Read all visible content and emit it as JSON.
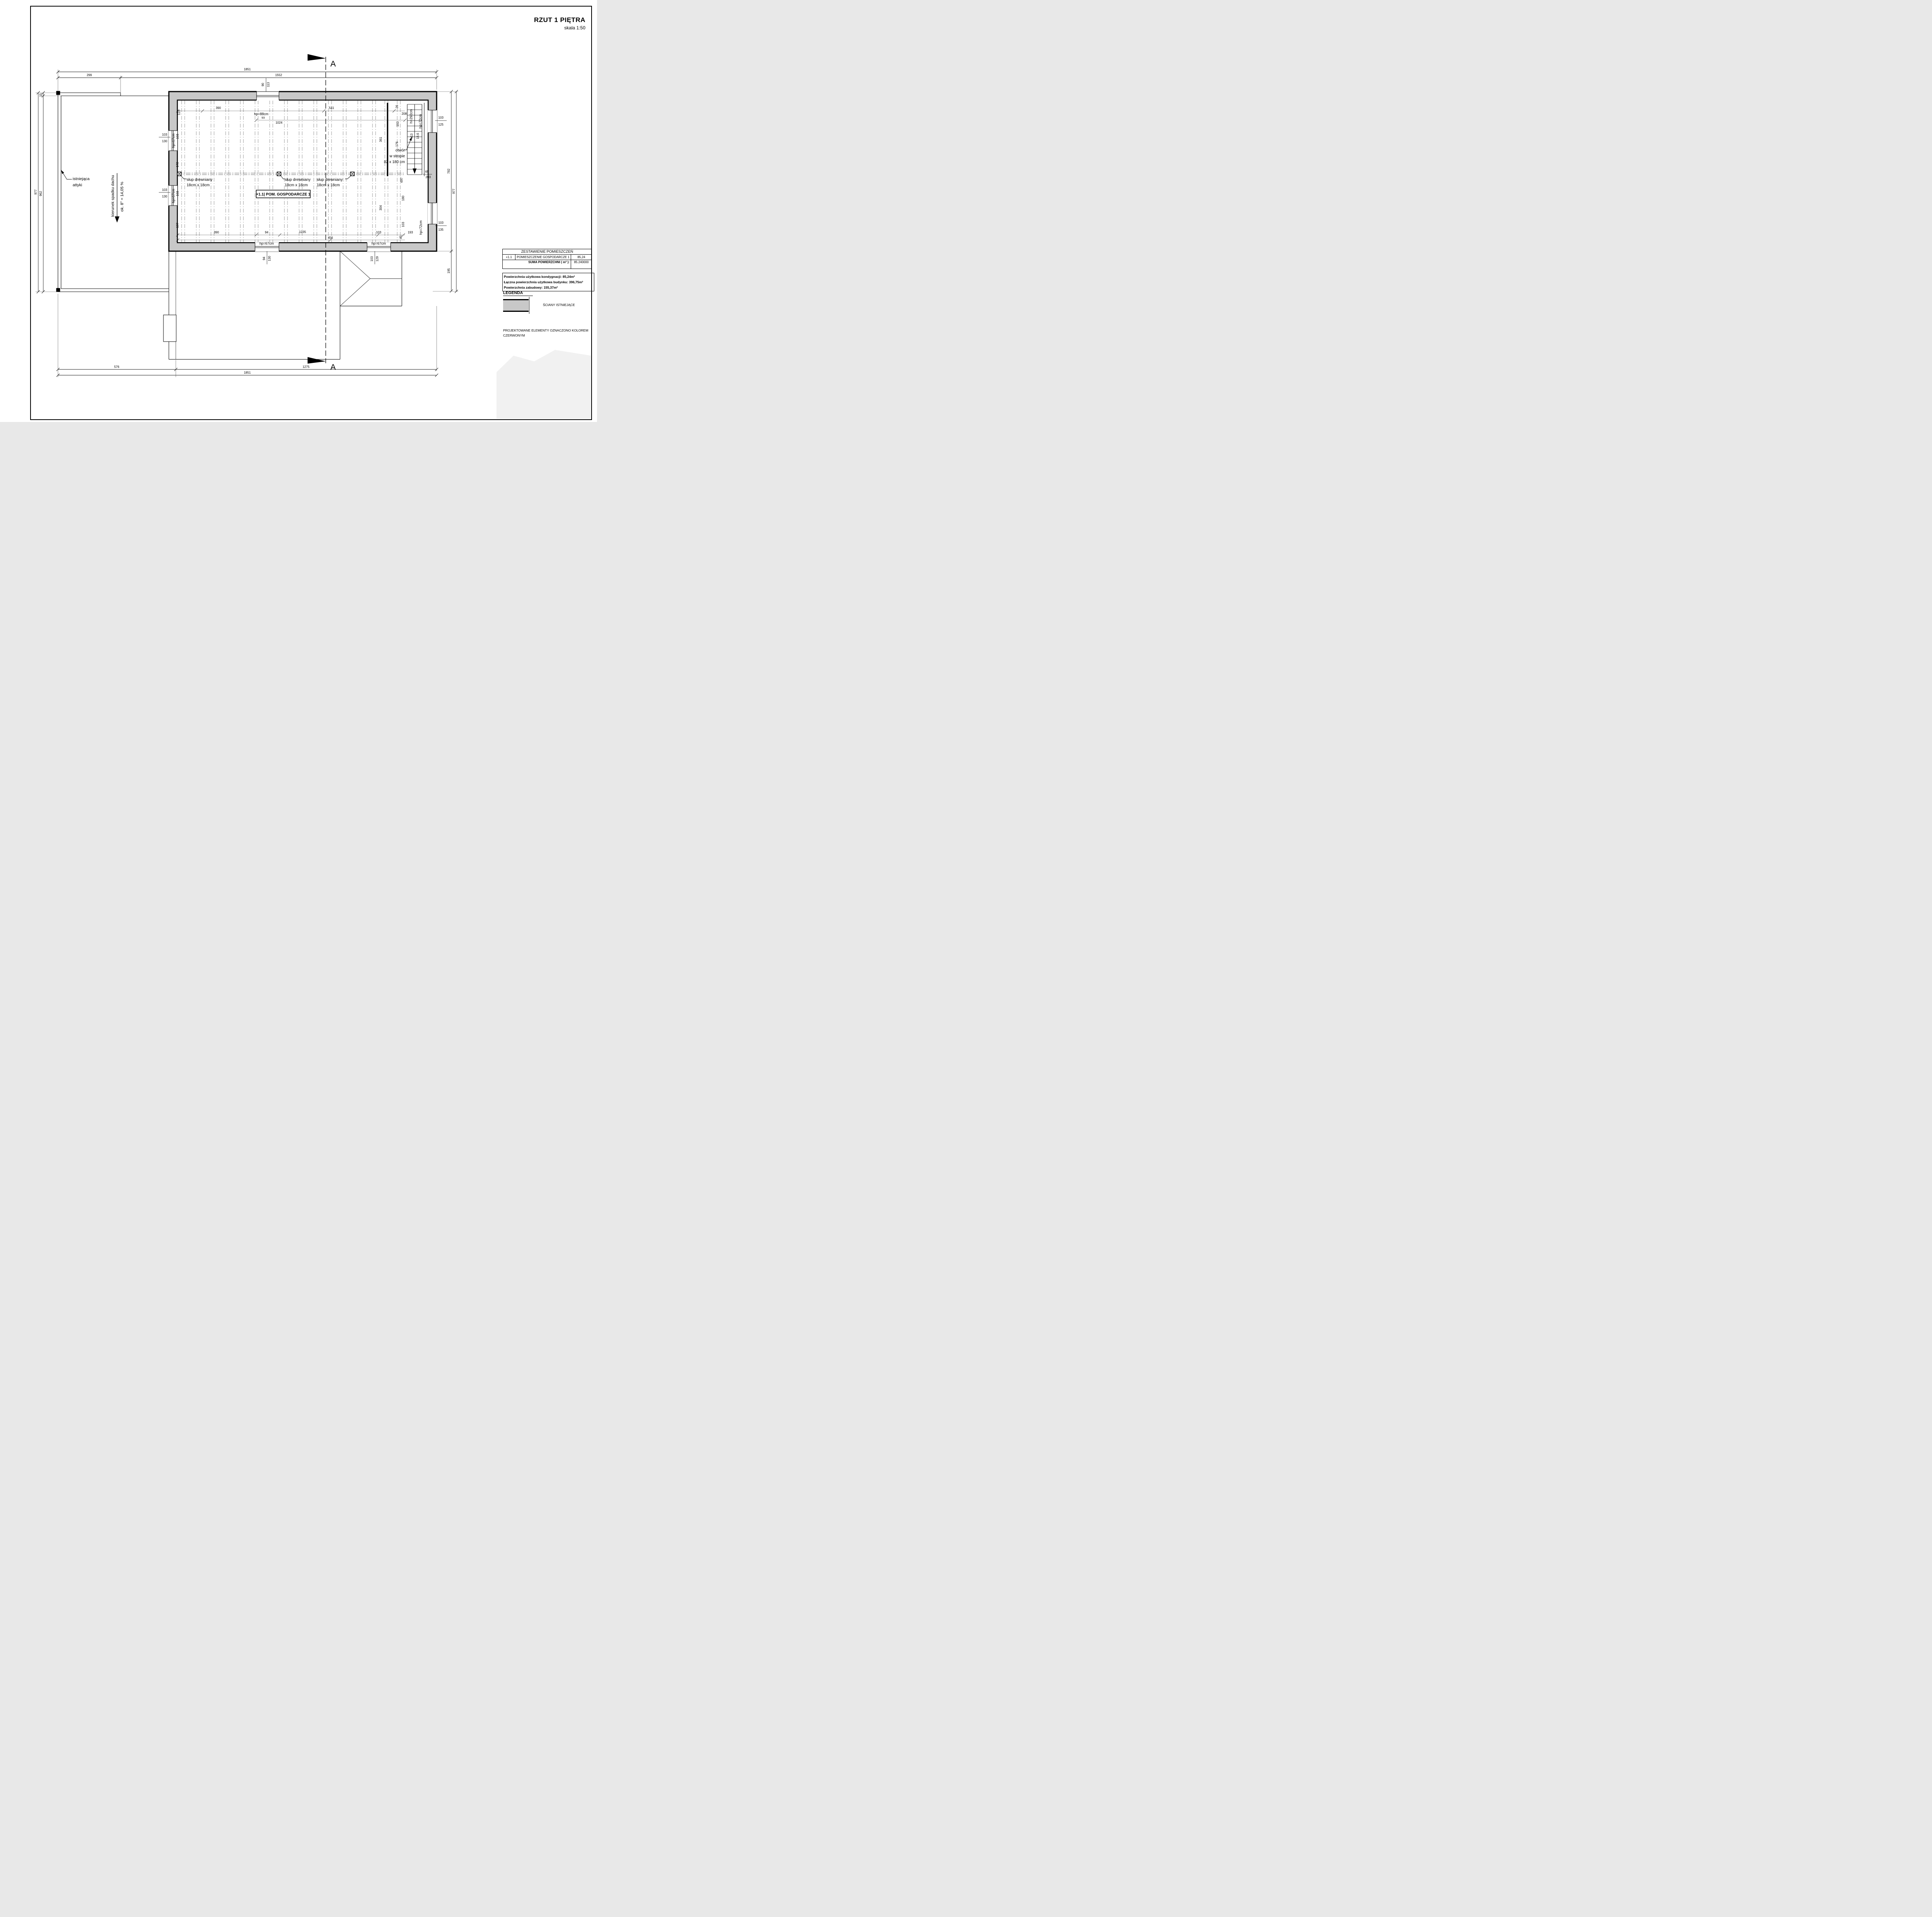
{
  "title": {
    "main": "RZUT 1 PIĘTRA",
    "scale": "skala 1:50"
  },
  "plan": {
    "room_label": "+1.1| POM. GOSPODARCZE 1",
    "attic_l1": "istniejąca",
    "attic_l2": "attyki",
    "roof_dir": "kierunek spadku dachu",
    "roof_slope": "ok. 8° = 14,05 %",
    "post_l1": "słup drewniany",
    "post_l2": "18cm x 18cm",
    "open_l1": "otwór",
    "open_l2": "w stropie",
    "open_l3": "82 x 180 cm",
    "stairs_count": "x13",
    "stairs_going": "18,6",
    "stairs_h": "h=292cm",
    "section": "A",
    "dims": {
      "t1851": "1851",
      "t299": "299",
      "t1552": "1552",
      "b576": "576",
      "b1275": "1275",
      "b1851": "1851",
      "l977": "977",
      "l15": "15",
      "l962": "962",
      "r782": "782",
      "r195": "195",
      "r977": "977",
      "tw_w": "90",
      "tw_h": "113",
      "tw_hp": "hp=88cm",
      "i122": "122",
      "i390": "390",
      "i93": "93",
      "i1024": "1024",
      "i541": "541",
      "i26": "26",
      "i208": "208",
      "i103s": "103",
      "i176": "176",
      "rw1_hp": "hp=72cm",
      "rw1_w": "103",
      "rw1_h": "125",
      "i361": "361",
      "i697": "697",
      "i180": "180",
      "i304": "304",
      "i103r": "103",
      "i65": "65",
      "i203": "203",
      "lw_hp": "hp=67cm",
      "lw_w": "103",
      "lw_h": "130",
      "il103a": "103",
      "il172": "172",
      "il103b": "103",
      "il197": "197",
      "bb390": "390",
      "bb94": "94",
      "bb1235": "1235",
      "bb456": "456",
      "bb103": "103",
      "bb45": "45",
      "bb193": "193",
      "bw_hp": "hp=67cm",
      "bw1_w": "94",
      "bw1_h": "130",
      "bw2_w": "103",
      "bw2_h": "129",
      "rw2_hp": "hp=72cm",
      "rw2_w": "103",
      "rw2_h": "135"
    }
  },
  "table": {
    "title": "ZESTAWIENIE POMIESZCZEŃ",
    "row_id": "+1.1",
    "row_name": "POMIESZCZENIE GOSPODARCZE 1",
    "row_area": "85,24",
    "sum_label": "SUMA POWIERZCHNI ( m² ):",
    "sum_value": "85.240000"
  },
  "summary": {
    "l1": "Powierzchnia użytkowa kondygnacji:  85,24m²",
    "l2": "Łączna powierzchnia użytkowa budynku:  396,75m²",
    "l3": "Powierzchnia zabudowy:  155,37m²"
  },
  "legend": {
    "title": "LEGENDA",
    "wall_label": "ŚCIANY ISTNIEJĄCE"
  },
  "note": {
    "l1": "PROJEKTOWANE ELEMENTY OZNACZONO KOLOREM",
    "l2": "CZERWONYM"
  },
  "colors": {
    "wall_fill": "#c8c8c8",
    "line": "#000000"
  }
}
